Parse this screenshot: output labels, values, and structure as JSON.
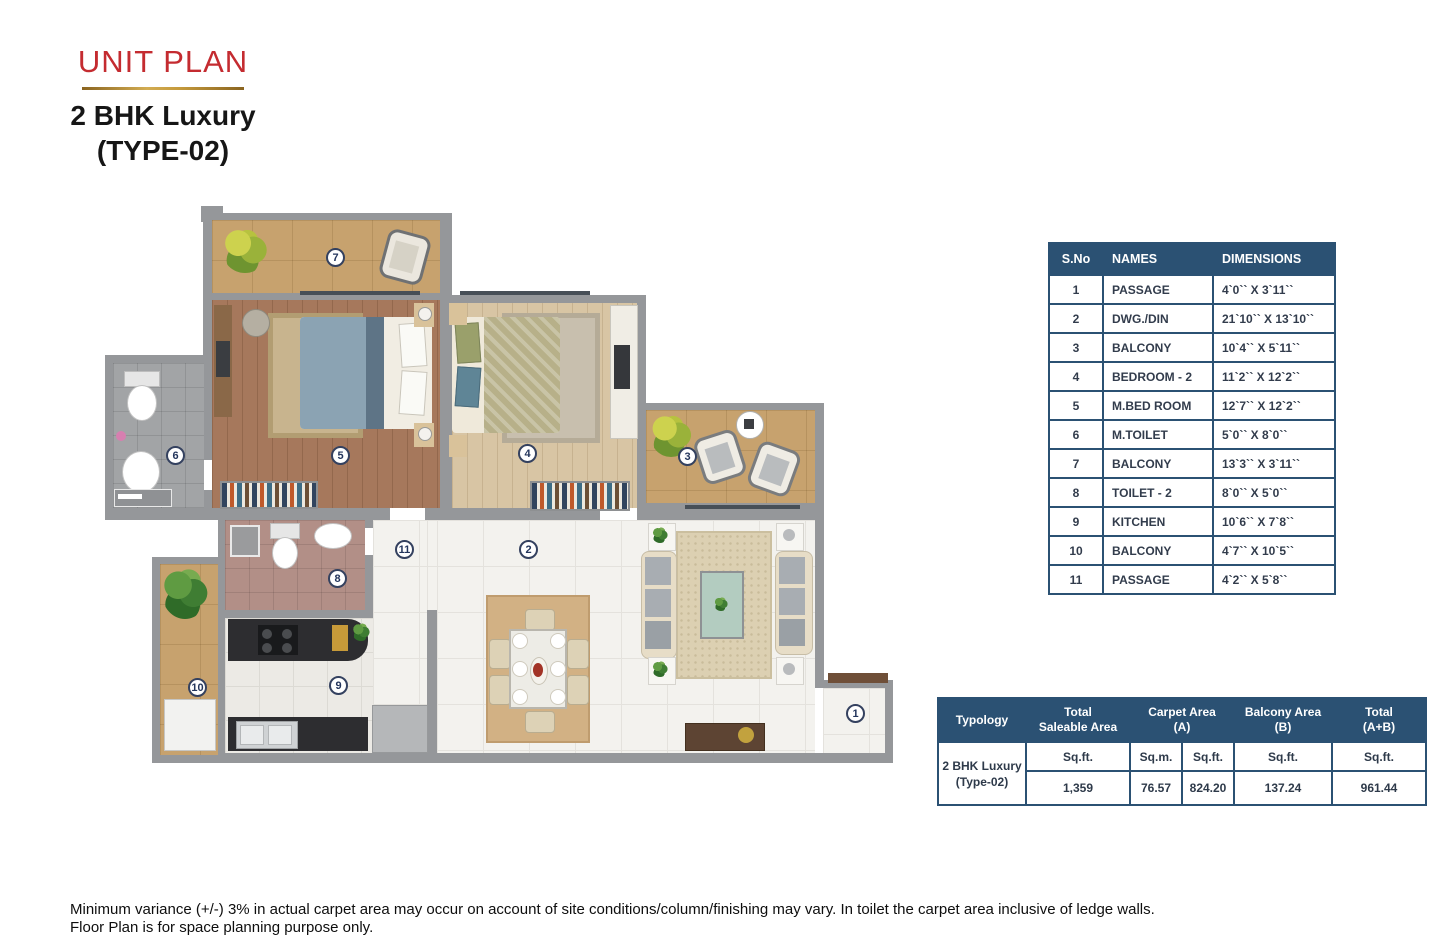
{
  "header": {
    "title": "UNIT PLAN",
    "subtitle_line1": "2 BHK Luxury",
    "subtitle_line2": "(TYPE-02)",
    "accent_color": "#c42b30",
    "rule_color": "#c59a3c"
  },
  "dimensions_table": {
    "header_bg": "#2b5173",
    "headers": {
      "sno": "S.No",
      "names": "NAMES",
      "dimensions": "DIMENSIONS"
    },
    "rows": [
      {
        "sno": "1",
        "name": "PASSAGE",
        "dim": "4`0`` X 3`11``"
      },
      {
        "sno": "2",
        "name": "DWG./DIN",
        "dim": "21`10`` X 13`10``"
      },
      {
        "sno": "3",
        "name": "BALCONY",
        "dim": "10`4`` X 5`11``"
      },
      {
        "sno": "4",
        "name": "BEDROOM - 2",
        "dim": "11`2`` X 12`2``"
      },
      {
        "sno": "5",
        "name": "M.BED ROOM",
        "dim": "12`7`` X 12`2``"
      },
      {
        "sno": "6",
        "name": "M.TOILET",
        "dim": "5`0`` X 8`0``"
      },
      {
        "sno": "7",
        "name": "BALCONY",
        "dim": "13`3`` X 3`11``"
      },
      {
        "sno": "8",
        "name": "TOILET - 2",
        "dim": "8`0`` X 5`0``"
      },
      {
        "sno": "9",
        "name": "KITCHEN",
        "dim": "10`6`` X 7`8``"
      },
      {
        "sno": "10",
        "name": "BALCONY",
        "dim": "4`7`` X 10`5``"
      },
      {
        "sno": "11",
        "name": "PASSAGE",
        "dim": "4`2`` X 5`8``"
      }
    ]
  },
  "area_table": {
    "header_bg": "#2b5173",
    "col_typology": "Typology",
    "col_total_saleable_l1": "Total",
    "col_total_saleable_l2": "Saleable Area",
    "col_carpet_l1": "Carpet Area",
    "col_carpet_l2": "(A)",
    "col_balcony_l1": "Balcony Area",
    "col_balcony_l2": "(B)",
    "col_total_ab_l1": "Total",
    "col_total_ab_l2": "(A+B)",
    "typology_line1": "2 BHK Luxury",
    "typology_line2": "(Type-02)",
    "units": {
      "saleable": "Sq.ft.",
      "carpet_m": "Sq.m.",
      "carpet_ft": "Sq.ft.",
      "balcony": "Sq.ft.",
      "total": "Sq.ft."
    },
    "values": {
      "saleable": "1,359",
      "carpet_m": "76.57",
      "carpet_ft": "824.20",
      "balcony": "137.24",
      "total": "961.44"
    }
  },
  "floor_plan": {
    "badges": [
      {
        "n": "1"
      },
      {
        "n": "2"
      },
      {
        "n": "3"
      },
      {
        "n": "4"
      },
      {
        "n": "5"
      },
      {
        "n": "6"
      },
      {
        "n": "7"
      },
      {
        "n": "8"
      },
      {
        "n": "9"
      },
      {
        "n": "10"
      },
      {
        "n": "11"
      }
    ]
  },
  "footer": {
    "line1": "Minimum variance (+/-) 3% in actual carpet area may occur on account of site conditions/column/finishing may vary. In toilet the carpet area inclusive of ledge walls.",
    "line2": "Floor Plan is for space planning purpose only."
  }
}
